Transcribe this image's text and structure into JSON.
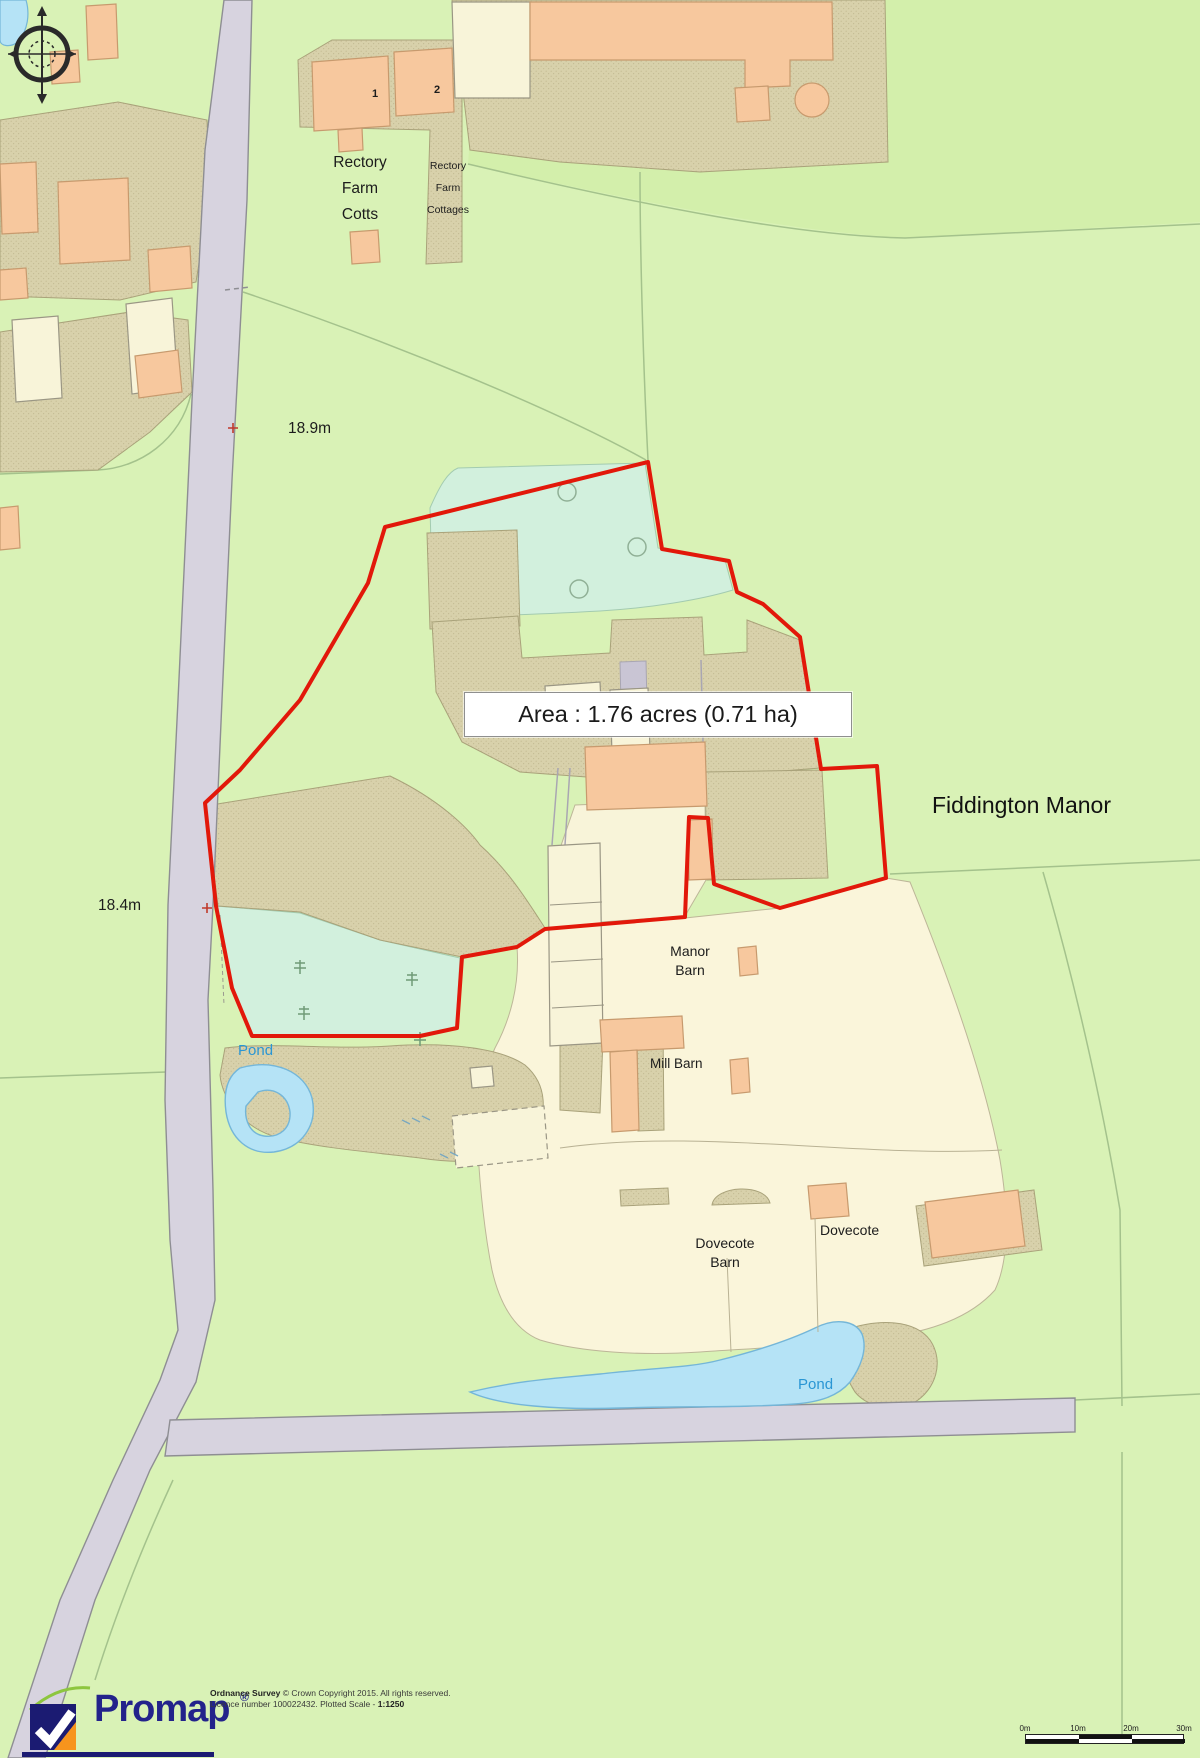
{
  "map": {
    "labels": {
      "rectory_farm_cotts": "Rectory\nFarm\nCotts",
      "rectory_farm_cottages": "Rectory\nFarm\nCottages",
      "cottage_number_1": "1",
      "cottage_number_2": "2",
      "spot_height_north": "18.9m",
      "spot_height_south": "18.4m",
      "area_label": "Area : 1.76 acres (0.71 ha)",
      "property_name": "Fiddington Manor",
      "manor_barn": "Manor\nBarn",
      "mill_barn": "Mill Barn",
      "dovecote_barn": "Dovecote\nBarn",
      "dovecote": "Dovecote",
      "pond_west": "Pond",
      "pond_south": "Pond"
    },
    "colors": {
      "boundary_red": "#e2180a",
      "field_green": "#d9f2b6",
      "water_blue": "#b5e3f6",
      "water_text_blue": "#2a96d4",
      "building_peach": "#f7c89e",
      "building_cream": "#f8f4d9",
      "yard_khaki": "#d8d1ab",
      "garden_mint": "#d2f0dd",
      "road_grey": "#d7d3df"
    }
  },
  "scale_bar": {
    "labels": [
      "0m",
      "10m",
      "20m",
      "30m"
    ]
  },
  "footer": {
    "logo_text": "Promap",
    "registered_mark": "®",
    "copyright_bold": "Ordnance Survey",
    "copyright_line1": "© Crown Copyright 2015. All rights reserved.",
    "copyright_line2": "Licence number 100022432. Plotted Scale - ",
    "plotted_scale": "1:1250"
  }
}
